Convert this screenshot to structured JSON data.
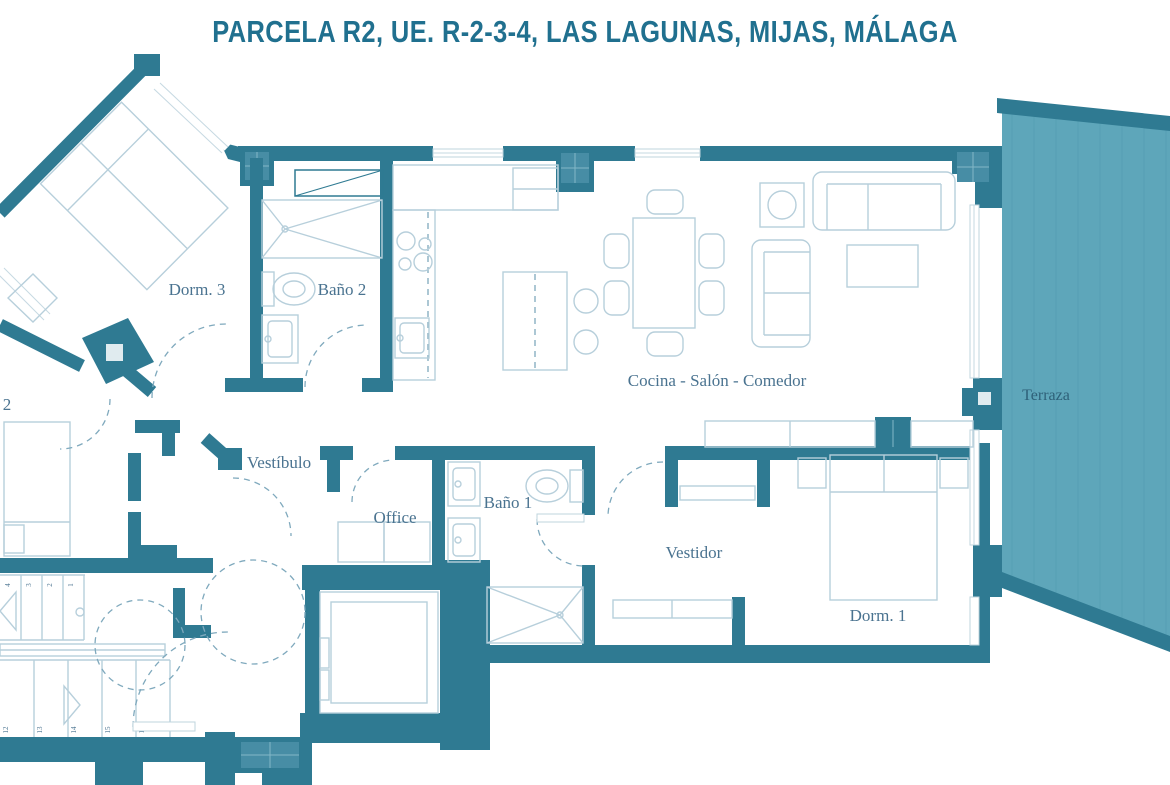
{
  "title": "PARCELA R2, UE. R-2-3-4, LAS LAGUNAS, MIJAS, MÁLAGA",
  "rooms": {
    "dorm3": {
      "label": "Dorm. 3"
    },
    "bano2": {
      "label": "Baño 2"
    },
    "cocina_salon_comedor": {
      "label": "Cocina - Salón - Comedor"
    },
    "terraza": {
      "label": "Terraza"
    },
    "dorm2_partial": {
      "label": "2"
    },
    "vestibulo": {
      "label": "Vestíbulo"
    },
    "office": {
      "label": "Office"
    },
    "bano1": {
      "label": "Baño 1"
    },
    "vestidor": {
      "label": "Vestidor"
    },
    "dorm1": {
      "label": "Dorm. 1"
    }
  },
  "stairs": {
    "upper_step_numbers": [
      "4",
      "3",
      "2",
      "1"
    ],
    "lower_step_numbers": [
      "12",
      "13",
      "14",
      "15",
      "16"
    ]
  },
  "colors": {
    "wall": "#2f7a92",
    "terrace_fill": "#5ea6ba",
    "terrace_band": "#2f7a92",
    "furniture_line": "#b7cfdb",
    "dashed_line": "#7fa9bd",
    "room_label": "#4a7390",
    "title": "#20708f",
    "background": "#ffffff"
  }
}
